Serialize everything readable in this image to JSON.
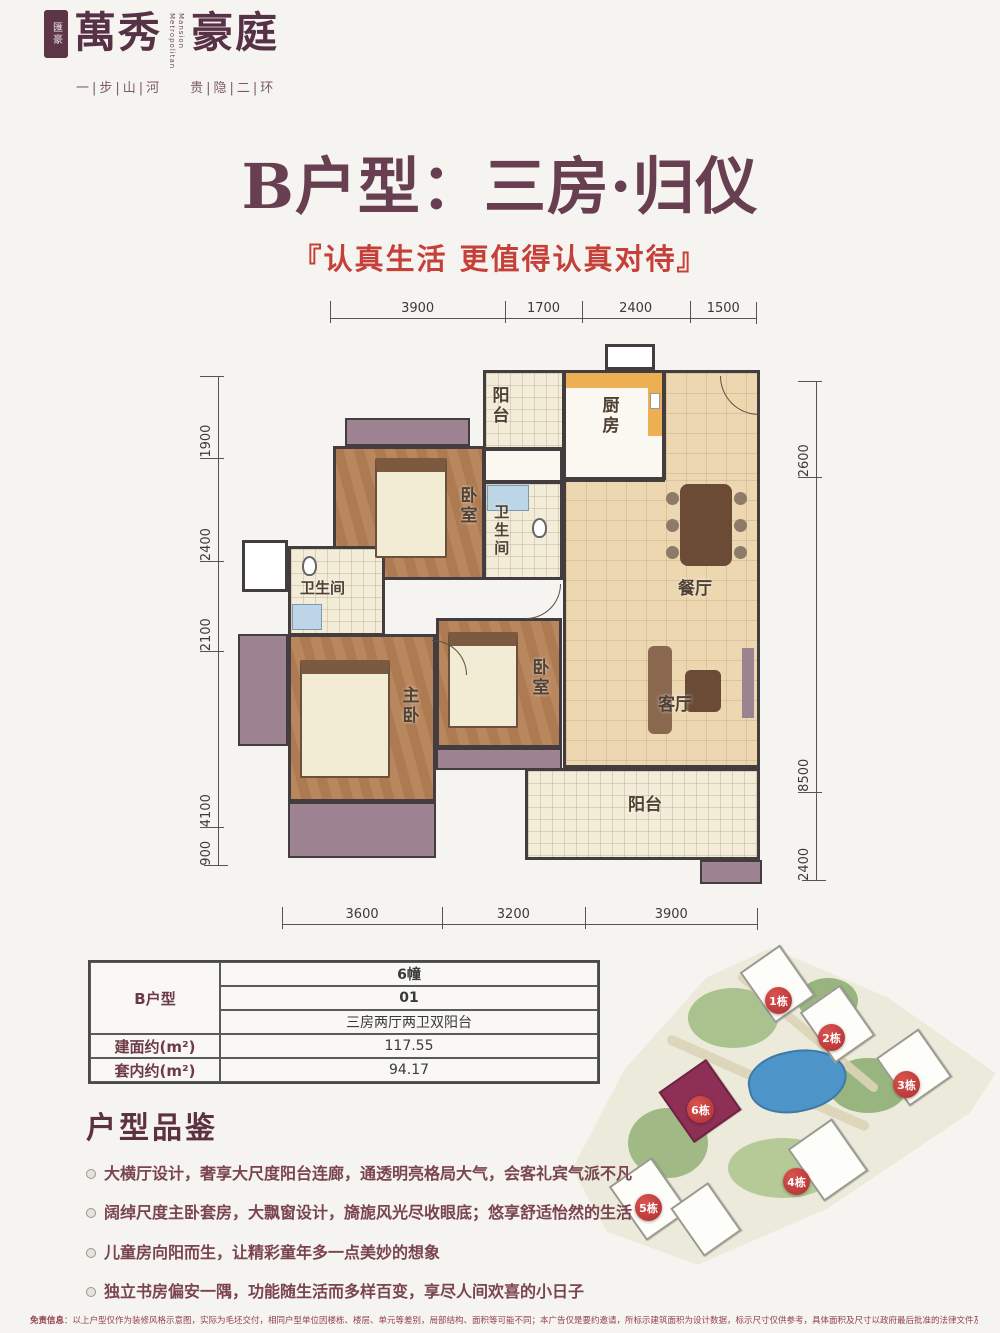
{
  "colors": {
    "title_maroon": "#683f51",
    "slogan_red": "#c6403a",
    "badge_red": "#b5343a",
    "highlight_building": "#8e2f56",
    "wall": "#433d3f",
    "wood_floor": "#b4835c",
    "tile_floor": "#ecd7b0",
    "mauve_accent": "#9e8492",
    "kitchen_counter": "#ecaf53"
  },
  "logo": {
    "seal_text": "匯豪",
    "name_part1": "萬秀",
    "name_part2": "豪庭",
    "name_en_line1": "Metropolitan",
    "name_en_line2": "Mansion",
    "tagline_left": "一|步|山|河",
    "tagline_right": "贵|隐|二|环"
  },
  "header": {
    "title": "B户型：三房·归仪",
    "subtitle": "『认真生活 更值得认真对待』"
  },
  "floorplan": {
    "dims_top": [
      "3900",
      "1700",
      "2400",
      "1500"
    ],
    "dims_left": [
      "1900",
      "2400",
      "2100",
      "4100",
      "900"
    ],
    "dims_right": [
      "2600",
      "8500",
      "2400"
    ],
    "dims_bottom": [
      "3600",
      "3200",
      "3900"
    ],
    "rooms": [
      {
        "name": "balcony-top",
        "label": "阳台"
      },
      {
        "name": "kitchen",
        "label": "厨房"
      },
      {
        "name": "dining",
        "label": "餐厅"
      },
      {
        "name": "bedroom-top",
        "label": "卧室"
      },
      {
        "name": "bath-middle",
        "label": "卫生间"
      },
      {
        "name": "bath-left",
        "label": "卫生间"
      },
      {
        "name": "master-bedroom",
        "label": "主卧"
      },
      {
        "name": "bedroom-bottom",
        "label": "卧室"
      },
      {
        "name": "living",
        "label": "客厅"
      },
      {
        "name": "balcony-bottom",
        "label": "阳台"
      }
    ]
  },
  "spec_table": {
    "unit_label": "B户型",
    "building": "6幢",
    "unit_no": "01",
    "layout_desc": "三房两厅两卫双阳台",
    "gross_label": "建面约(m²)",
    "gross_value": "117.55",
    "net_label": "套内约(m²)",
    "net_value": "94.17"
  },
  "sitemap": {
    "badges": [
      {
        "label": "1栋"
      },
      {
        "label": "2栋"
      },
      {
        "label": "3栋"
      },
      {
        "label": "4栋"
      },
      {
        "label": "5栋"
      },
      {
        "label": "6栋"
      }
    ]
  },
  "features": {
    "heading": "户型品鉴",
    "items": [
      "大横厅设计，奢享大尺度阳台连廊，通透明亮格局大气，会客礼宾气派不凡",
      "阔绰尺度主卧套房，大飘窗设计，旖旎风光尽收眼底；悠享舒适怡然的生活",
      "儿童房向阳而生，让精彩童年多一点美妙的想象",
      "独立书房偏安一隅，功能随生活而多样百变，享尽人间欢喜的小日子"
    ]
  },
  "disclaimer": {
    "label": "免责信息",
    "text": "：以上户型仅作为装修风格示意图，实际为毛坯交付，相同户型单位因楼栋、楼层、单元等差别，局部结构、面积等可能不同；本广告仅是要约邀请，所标示建筑面积为设计数据，标示尺寸仅供参考，具体面积及尺寸以政府最后批准的法律文件及双方签订的买卖合同约定为准。"
  }
}
